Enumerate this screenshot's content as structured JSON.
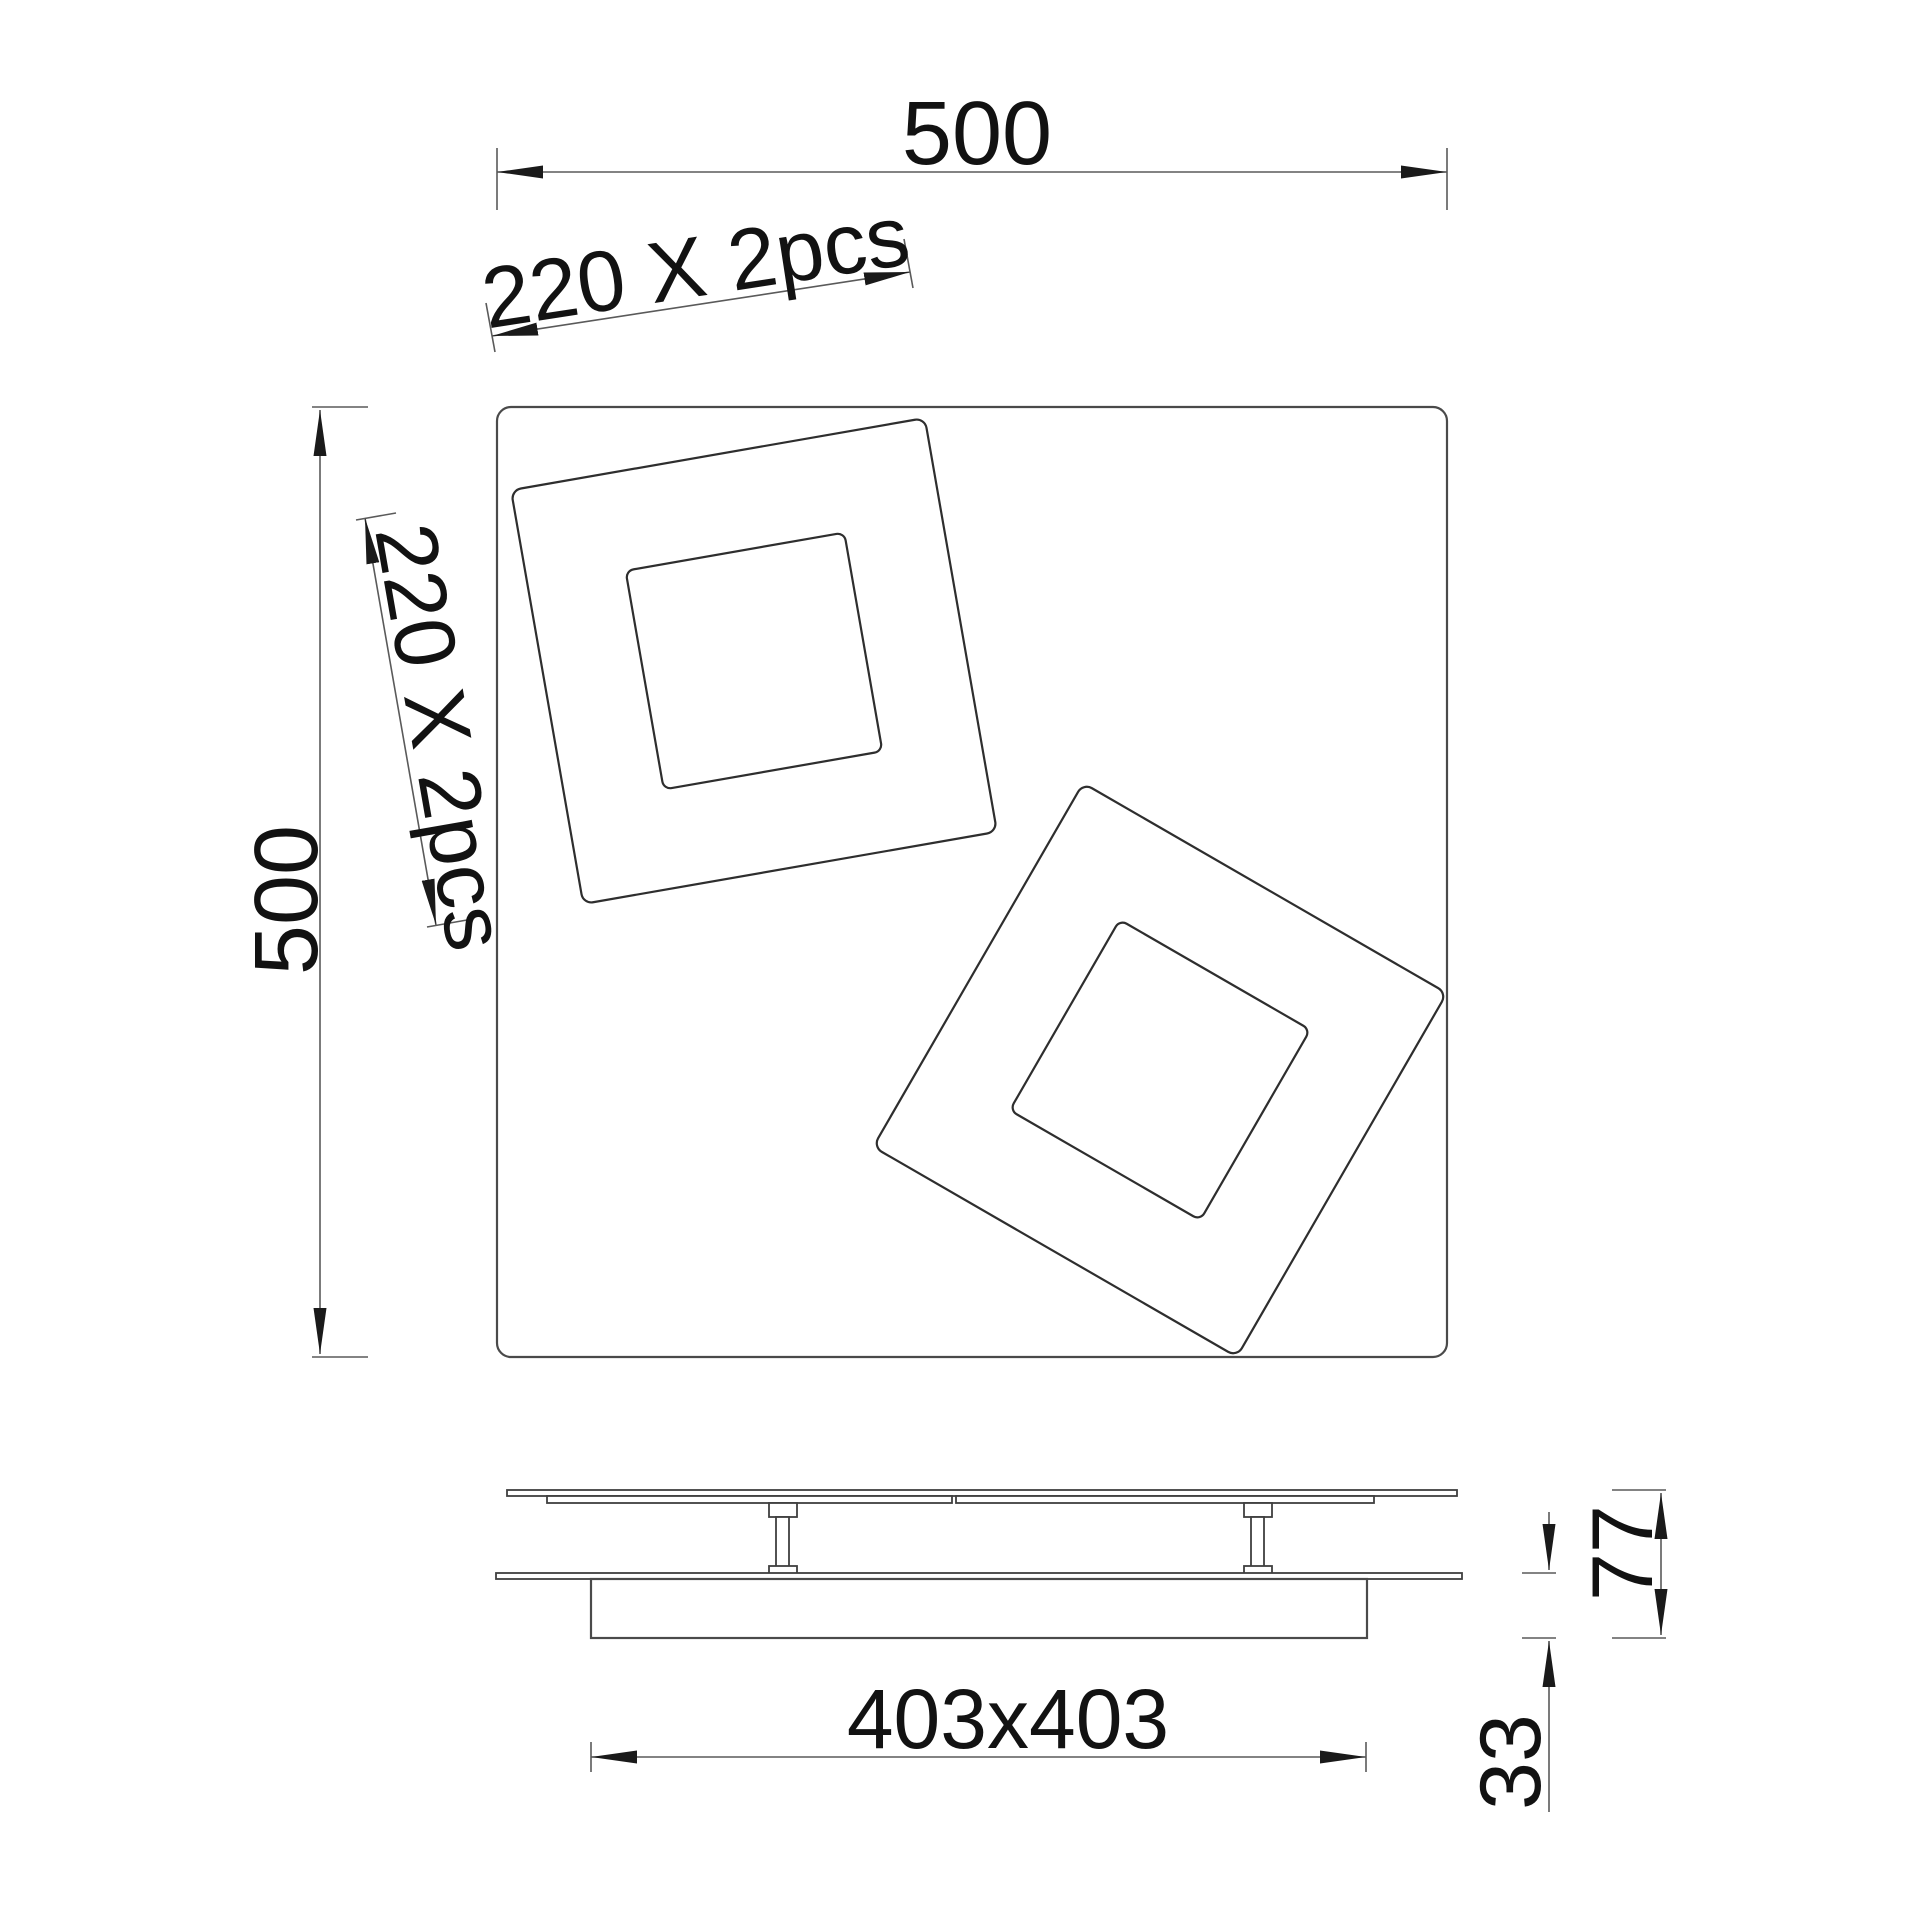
{
  "page": {
    "background": "#ffffff"
  },
  "drawing": {
    "plan_view": {
      "width_label": "500",
      "height_label": "500",
      "tile_width_label": "220 X 2pcs",
      "tile_height_label": "220 X 2pcs",
      "tiles_count": "2"
    },
    "side_view": {
      "base_label": "403x403",
      "total_height_label": "77",
      "base_height_label": "33"
    },
    "colors": {
      "object_line": "#4a4a4a",
      "tile_line": "#2e2e2e",
      "dimension_line": "#5a5a5a",
      "arrow_fill": "#1a1a1a",
      "text": "#121212",
      "background": "#ffffff"
    }
  }
}
